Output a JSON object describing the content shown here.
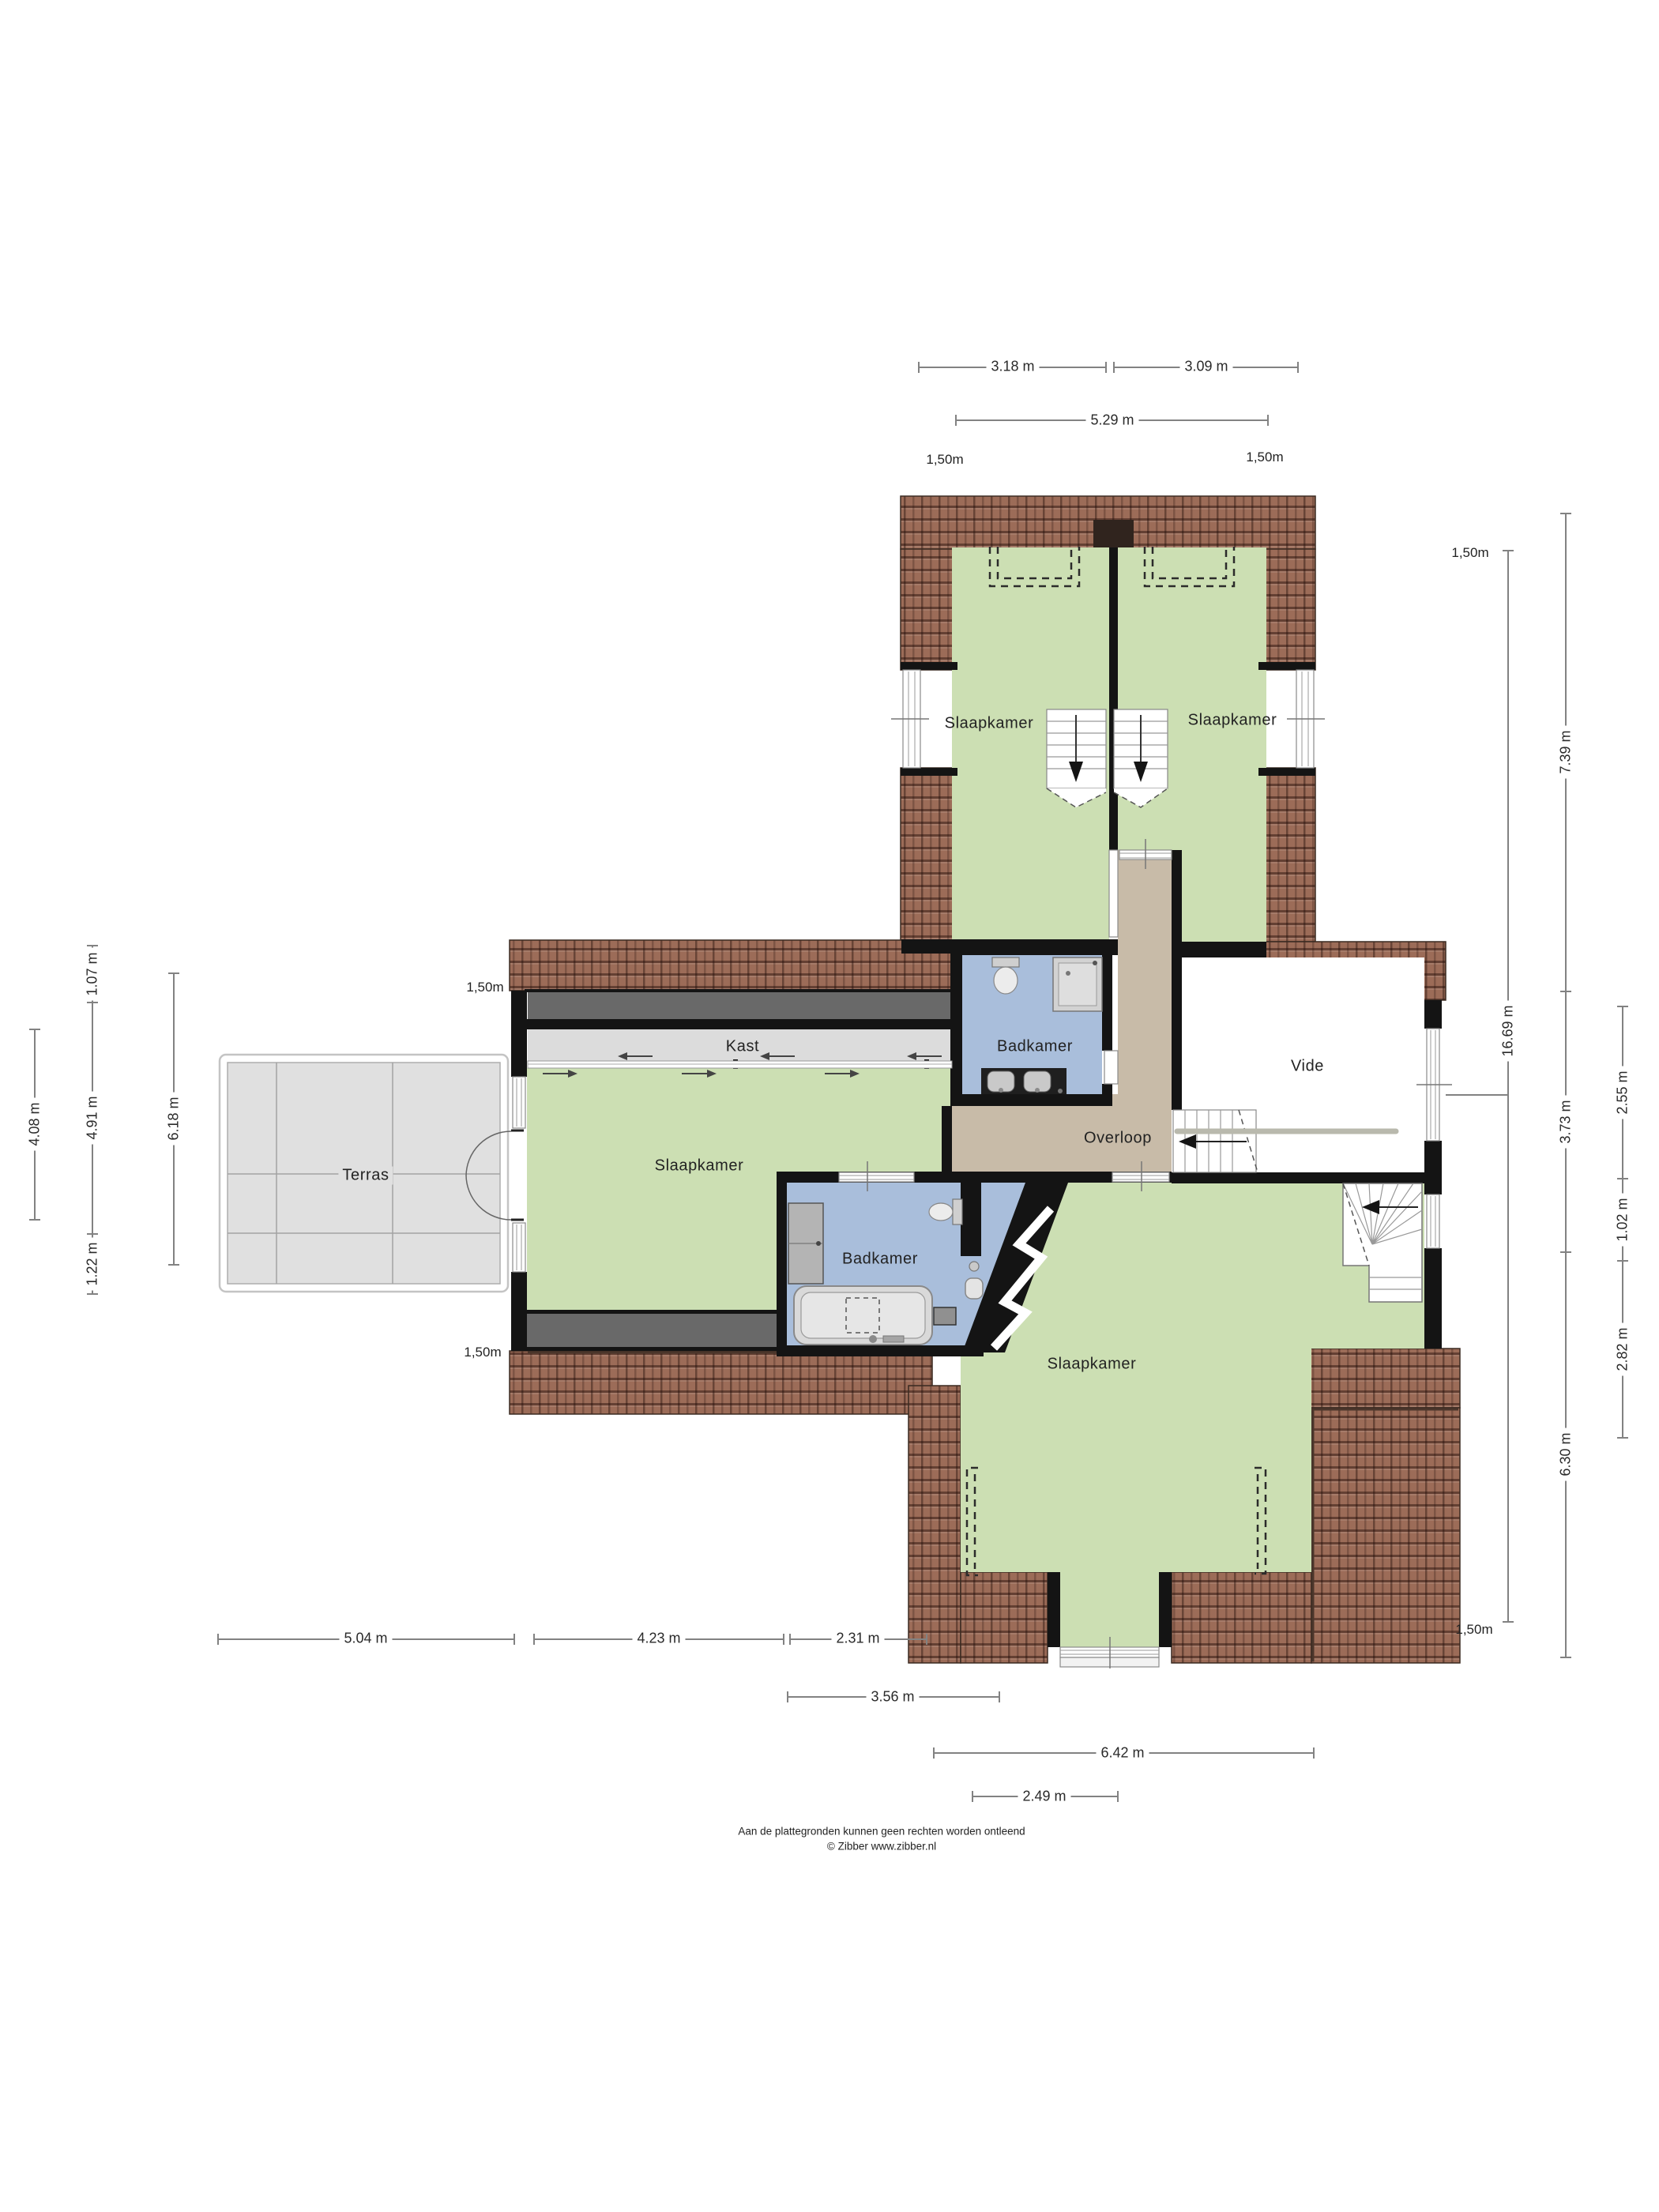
{
  "rooms": {
    "slaapkamer": "Slaapkamer",
    "badkamer": "Badkamer",
    "kast": "Kast",
    "vide": "Vide",
    "overloop": "Overloop",
    "terras": "Terras"
  },
  "dimensions": {
    "contour": "1,50m",
    "top_left": "3.18 m",
    "top_right": "3.09 m",
    "top_total": "5.29 m",
    "right_total": "16.69 m",
    "right_a": "7.39 m",
    "right_b": "3.73 m",
    "right_c": "6.30 m",
    "right_d": "2.55 m",
    "right_e": "1.02 m",
    "right_f": "2.82 m",
    "left_a": "1.07 m",
    "left_b": "4.91 m",
    "left_c": "1.22 m",
    "left_d": "4.08 m",
    "left_e": "6.18 m",
    "bottom_a": "5.04 m",
    "bottom_b": "4.23 m",
    "bottom_c": "2.31 m",
    "bottom_d": "3.56 m",
    "bottom_e": "6.42 m",
    "bottom_f": "2.49 m"
  },
  "footer": {
    "line1": "Aan de plattegronden kunnen geen rechten worden ontleend",
    "line2": "© Zibber www.zibber.nl"
  },
  "colors": {
    "green": "#ccdfb3",
    "blue": "#a9bedb",
    "tan": "#c8bba8",
    "kast": "#dcdcdc",
    "terras": "#e0e0e0",
    "band": "#696969",
    "wall": "#141414",
    "roof": "#9c6c58",
    "roofline": "#3a2a21",
    "dimline": "#828282"
  }
}
